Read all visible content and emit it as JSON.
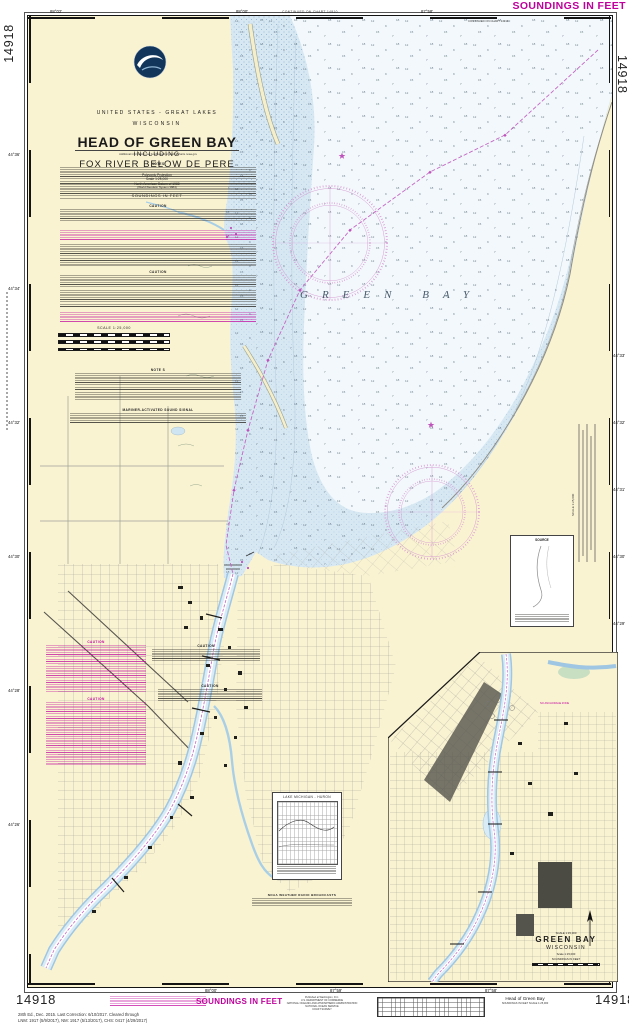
{
  "chart_number": "14918",
  "colors": {
    "magenta": "#c0009c",
    "land": "#faf3d2",
    "shallow_water": "#d7e8f3",
    "deep_water": "#f2f8fb",
    "channel_magenta": "#c468c4"
  },
  "margins": {
    "soundings_top": "SOUNDINGS IN FEET",
    "soundings_bottom": "SOUNDINGS IN FEET",
    "edition_line1": "28th Ed., Dec. 2015. Last Correction: 6/10/2017. Cleared through",
    "edition_line2": "LNM: 1917 (5/9/2017), NM: 1917 (5/13/2017), CHS: 0417 (4/29/2017)",
    "publisher_line1": "Published at Washington, D.C.",
    "publisher_line2": "U.S. DEPARTMENT OF COMMERCE",
    "publisher_line3": "NATIONAL OCEANIC AND ATMOSPHERIC ADMINISTRATION",
    "publisher_line4": "NATIONAL OCEAN SERVICE",
    "publisher_line5": "COAST SURVEY",
    "footer_title": "Head of Green Bay",
    "footer_sub": "SOUNDINGS IN FEET    SCALE 1:25,000"
  },
  "title_block": {
    "region": "UNITED STATES - GREAT LAKES",
    "state": "WISCONSIN",
    "title": "HEAD OF GREEN BAY",
    "including": "INCLUDING",
    "subtitle": "FOX RIVER BELOW DE PERE",
    "projection": "Polyconic Projection",
    "scale": "Scale 1:25,000",
    "datum": "North American Datum of 1983",
    "datum2": "(World Geodetic System 1984)",
    "soundings": "SOUNDINGS IN FEET"
  },
  "labels": {
    "notes": "NOTES",
    "caution": "CAUTION",
    "note_s": "NOTE S",
    "sound_signal": "MARINER-ACTIVATED SOUND SIGNAL",
    "weather": "NOAA WEATHER RADIO BROADCASTS",
    "info": "Additional information can be obtained at nauticalcharts.noaa.gov"
  },
  "map": {
    "water_label": "GREEN BAY",
    "continued": "CONTINUED ON CHART 14910",
    "lake_box_title": "LAKE MICHIGAN - HURON",
    "source_box": "SOURCE",
    "scale_label": "SCALE 1:25,000",
    "no_anchorage": "NO ANCHORAGE ZONE",
    "soundings_sample": [
      "12",
      "9",
      "15",
      "7",
      "18"
    ]
  },
  "inset": {
    "scale_top": "SCALE 1:15,000",
    "title": "GREEN BAY",
    "state": "WISCONSIN",
    "scale": "Scale 1:15,000",
    "soundings": "SOUNDINGS IN FEET"
  },
  "graticule": {
    "top": [
      {
        "label": "88°02'"
      },
      {
        "label": "88°00'"
      },
      {
        "label": "87°58'"
      }
    ],
    "bottom": [
      {
        "label": "88°00'"
      },
      {
        "label": "87°59'"
      },
      {
        "label": "87°58'"
      }
    ],
    "left": [
      {
        "label": "44°36'"
      },
      {
        "label": "44°34'"
      },
      {
        "label": "44°32'"
      },
      {
        "label": "44°30'"
      },
      {
        "label": "44°28'"
      },
      {
        "label": "44°26'"
      }
    ],
    "right": [
      {
        "label": "44°33'"
      },
      {
        "label": "44°32'"
      },
      {
        "label": "44°31'"
      },
      {
        "label": "44°30'"
      },
      {
        "label": "44°29'"
      }
    ]
  }
}
